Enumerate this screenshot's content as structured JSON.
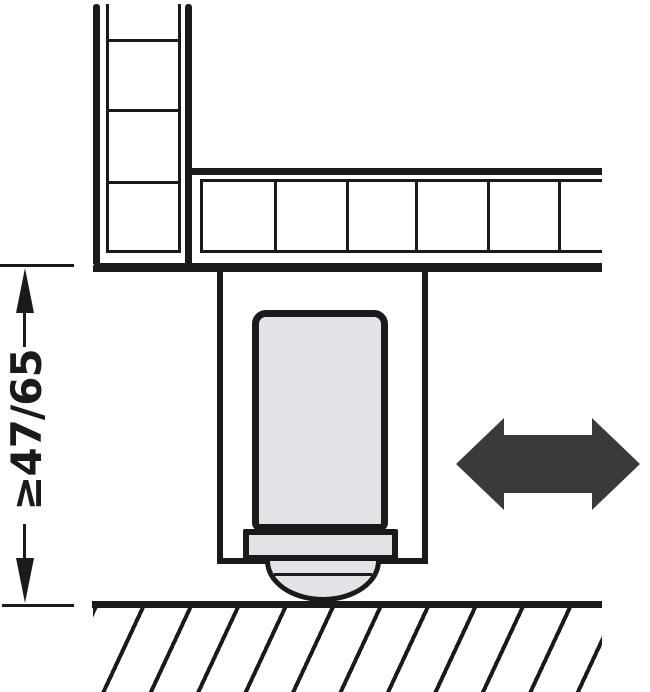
{
  "diagram": {
    "kind": "technical-cross-section-drawing",
    "dimension": {
      "label": "≥47/65"
    },
    "icons": {
      "adjustment_arrow": "double-headed-horizontal-arrow"
    },
    "components": {
      "side_panel": "cabinet-side-panel-cross-section",
      "bottom_panel": "cabinet-bottom-panel-cross-section",
      "plinth_leg": "plinth-leg-housing",
      "foot": "adjustable-foot",
      "floor": "floor-with-hatching"
    },
    "colors": {
      "line": "#1a1a1c",
      "component_fill": "#e2e3e6",
      "arrow_fill": "#3a3a3c",
      "background": "#ffffff"
    }
  }
}
